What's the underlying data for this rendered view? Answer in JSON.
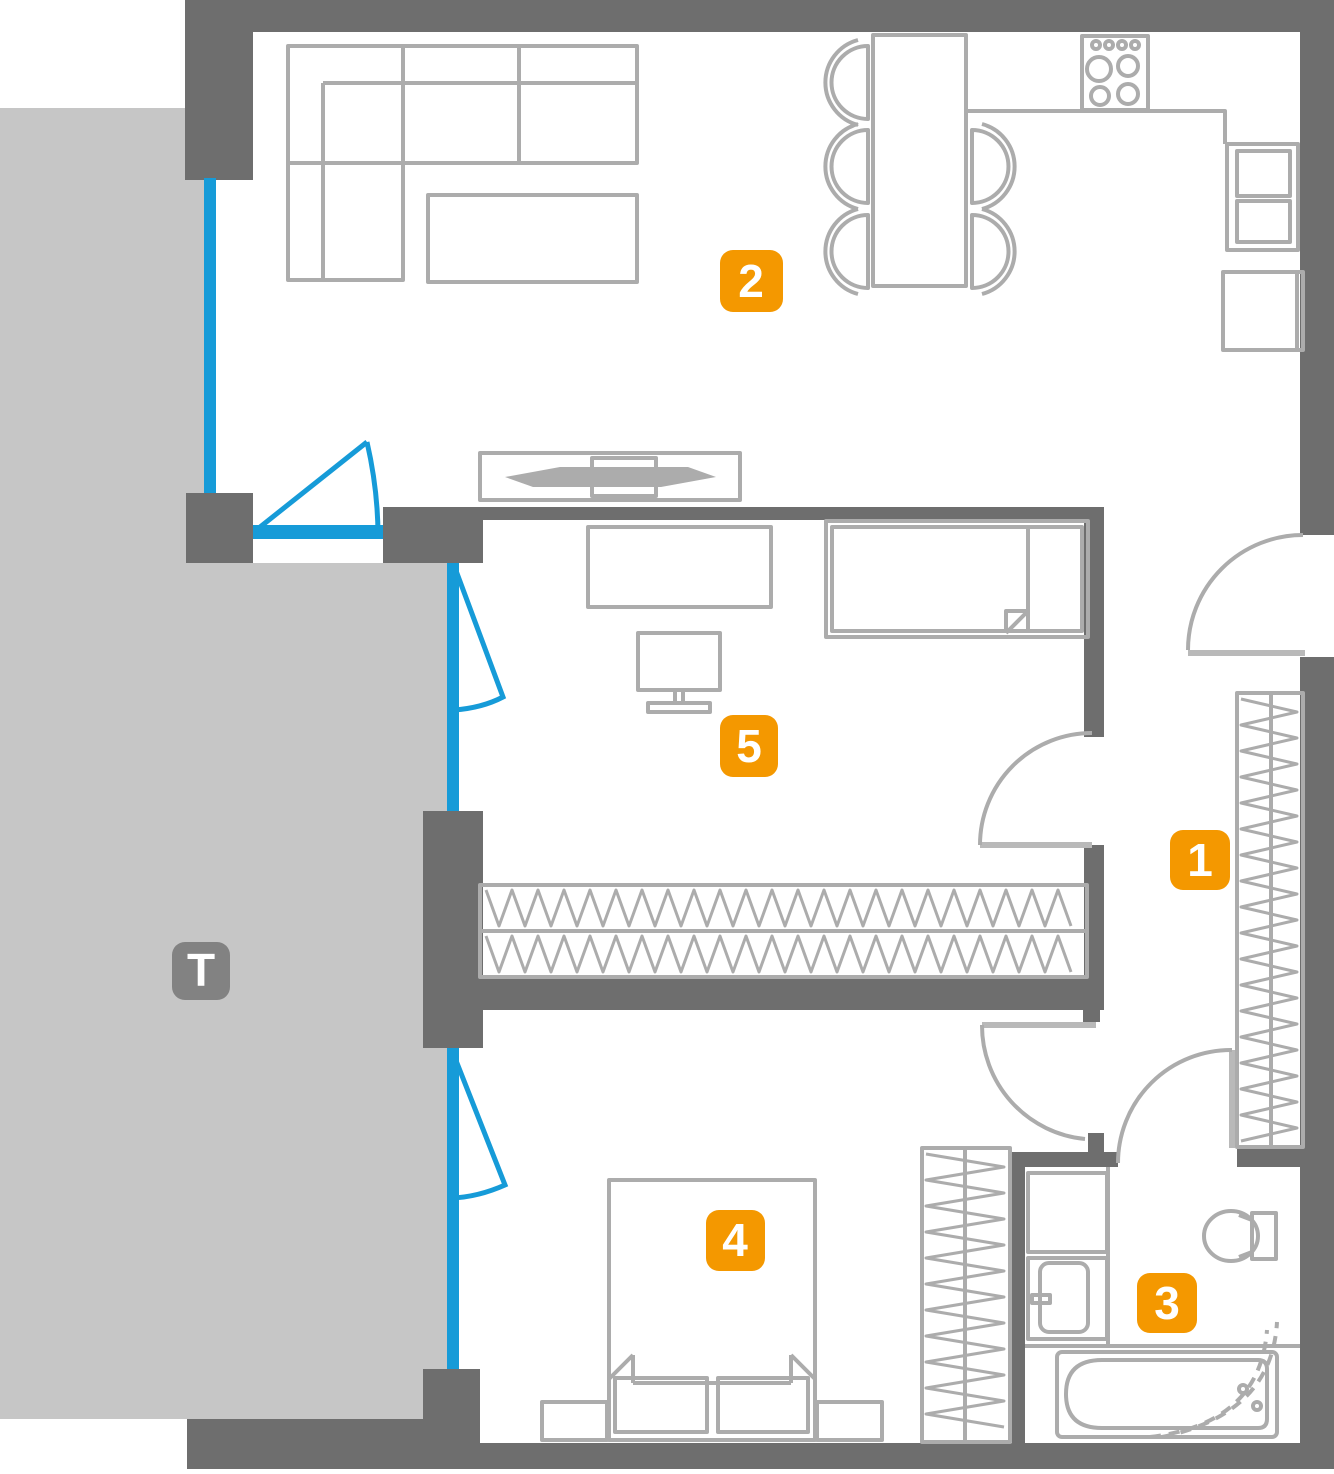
{
  "terrace": {
    "label": "T"
  },
  "rooms": [
    {
      "id": "hallway",
      "label": "1"
    },
    {
      "id": "living-room-kitchen",
      "label": "2"
    },
    {
      "id": "bathroom",
      "label": "3"
    },
    {
      "id": "bedroom",
      "label": "4"
    },
    {
      "id": "study-bedroom",
      "label": "5"
    }
  ],
  "colors": {
    "accent_badge": "#F49800",
    "terrace_badge": "#828282",
    "window_blue": "#169BD8",
    "wall_gray": "#6E6E6E",
    "furniture_gray": "#ACACAC",
    "terrace_fill": "#C6C6C6"
  }
}
